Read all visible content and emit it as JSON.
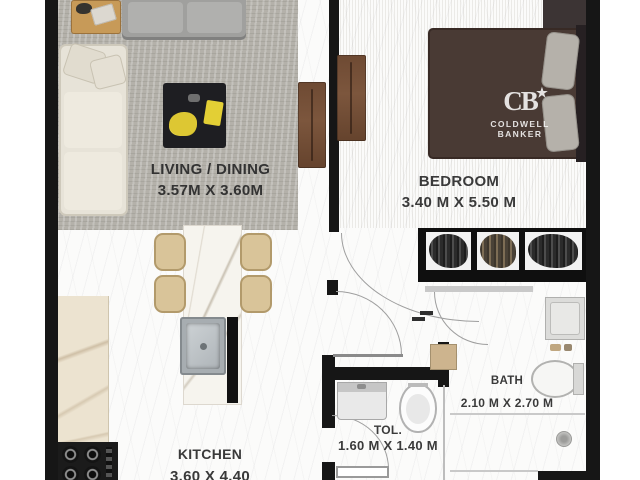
{
  "brand": {
    "monogram": "CB",
    "star": "★",
    "line1": "COLDWELL",
    "line2": "BANKER"
  },
  "rooms": {
    "living": {
      "name": "LIVING / DINING",
      "dims": "3.57M X 3.60M"
    },
    "bedroom": {
      "name": "BEDROOM",
      "dims": "3.40 M X 5.50 M"
    },
    "kitchen": {
      "name": "KITCHEN",
      "dims": "3.60 X 4.40"
    },
    "bath": {
      "name": "BATH",
      "dims": "2.10 M X 2.70 M"
    },
    "toilet": {
      "name": "TOL.",
      "dims": "1.60 M X 1.40 M"
    }
  },
  "colors": {
    "wall": "#161616",
    "rug": "#b4b1aa",
    "wood_door_panel": "#6e4a33",
    "bed": "#493a34",
    "pillow": "#b5b1aa",
    "sofa_cream": "#e7e3d8",
    "sofa_gray": "#a0a09e",
    "chair_tan": "#d9c499",
    "marble_counter": "#ece3d0",
    "accent_yellow": "#ddc733",
    "label_text": "#3a3a3a"
  }
}
